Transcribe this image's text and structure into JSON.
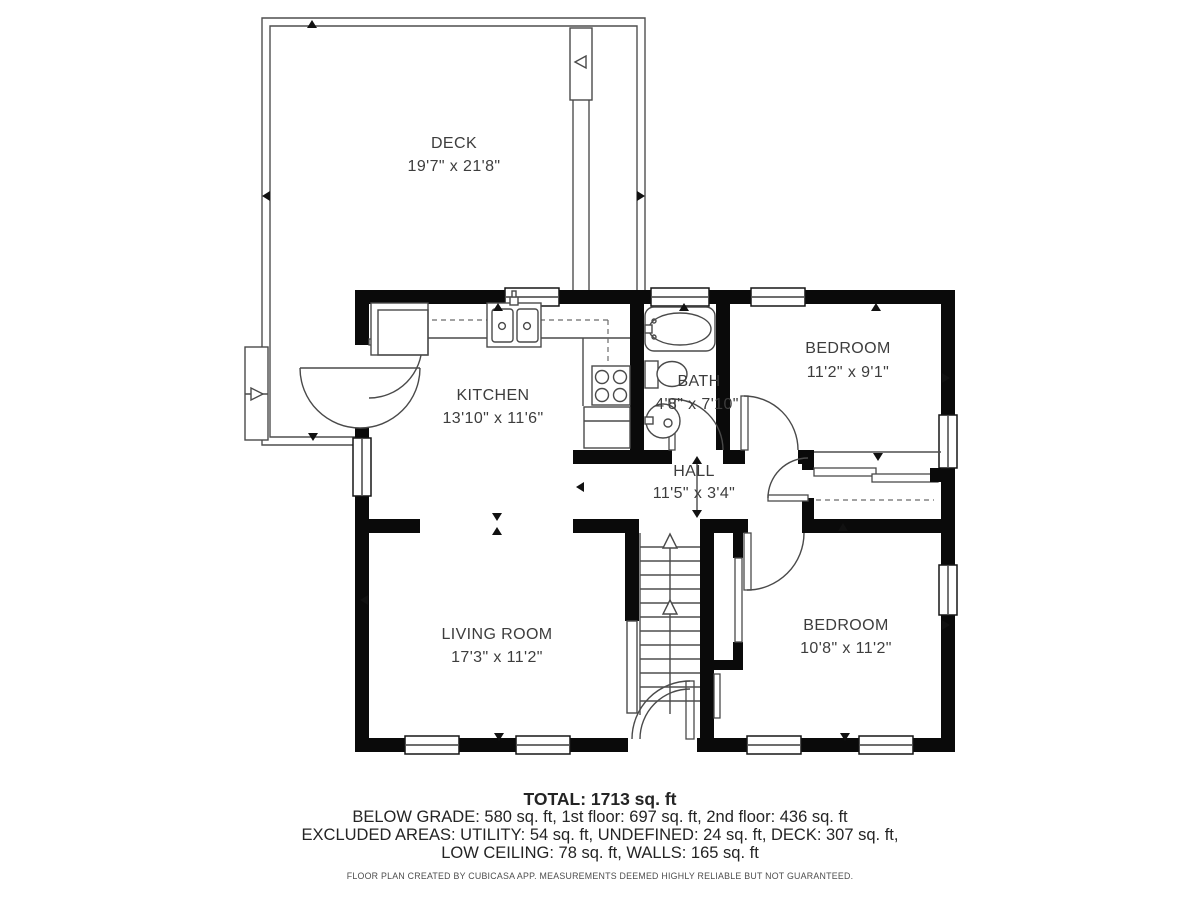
{
  "plan": {
    "rooms": {
      "deck": {
        "name": "DECK",
        "dims": "19'7\" x 21'8\""
      },
      "kitchen": {
        "name": "KITCHEN",
        "dims": "13'10\" x 11'6\""
      },
      "bath": {
        "name": "BATH",
        "dims": "4'8\" x 7'10\""
      },
      "bedroom1": {
        "name": "BEDROOM",
        "dims": "11'2\" x 9'1\""
      },
      "hall": {
        "name": "HALL",
        "dims": "11'5\" x 3'4\""
      },
      "living": {
        "name": "LIVING ROOM",
        "dims": "17'3\" x 11'2\""
      },
      "bedroom2": {
        "name": "BEDROOM",
        "dims": "10'8\" x 11'2\""
      }
    },
    "colors": {
      "walls": "#0a0a0a",
      "lines": "#4f4f4f",
      "label_text": "#3d3d3d"
    }
  },
  "summary": {
    "total": "TOTAL: 1713 sq. ft",
    "floors": "BELOW GRADE: 580 sq. ft, 1st floor: 697 sq. ft, 2nd floor: 436 sq. ft",
    "excluded": "EXCLUDED AREAS: UTILITY: 54 sq. ft, UNDEFINED: 24 sq. ft, DECK: 307 sq. ft,",
    "excluded2": "LOW CEILING: 78 sq. ft, WALLS: 165 sq. ft",
    "disclaimer": "FLOOR PLAN CREATED BY CUBICASA APP. MEASUREMENTS DEEMED HIGHLY RELIABLE BUT NOT GUARANTEED."
  }
}
